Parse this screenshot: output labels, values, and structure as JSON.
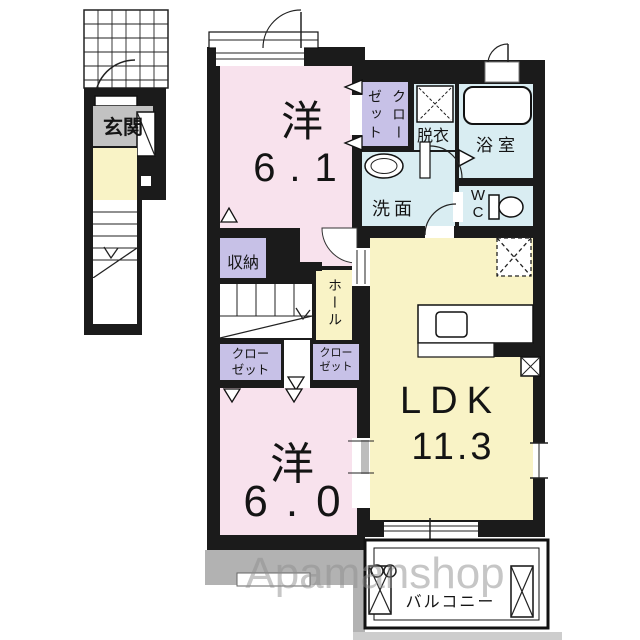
{
  "plan": {
    "type": "apartment-floor-plan",
    "labels": {
      "entrance": "玄関",
      "western_room_1": "洋",
      "western_room_1_size": "6.1",
      "closet_vertical": "クローゼット",
      "closet_two_line": "クロー\nゼット",
      "dressing_room": "脱衣",
      "bathroom": "浴室",
      "washroom": "洗面",
      "toilet": "W\nC",
      "storage": "収納",
      "hall": "ホール",
      "western_room_2": "洋",
      "western_room_2_size": "6.0",
      "ldk": "LDK",
      "ldk_size": "11.3",
      "balcony": "バルコニー"
    },
    "watermark": "Apamanshop",
    "colors": {
      "wall": "#1b1b1b",
      "room_pink": "#f8e2ed",
      "room_yellow": "#f9f3c6",
      "room_purple": "#c7c1e7",
      "room_blue": "#d9edf2",
      "entrance_gray": "#c2c2c2",
      "eave_gray": "#b2b2b2",
      "watermark_gray": "#8f8f8f"
    }
  }
}
